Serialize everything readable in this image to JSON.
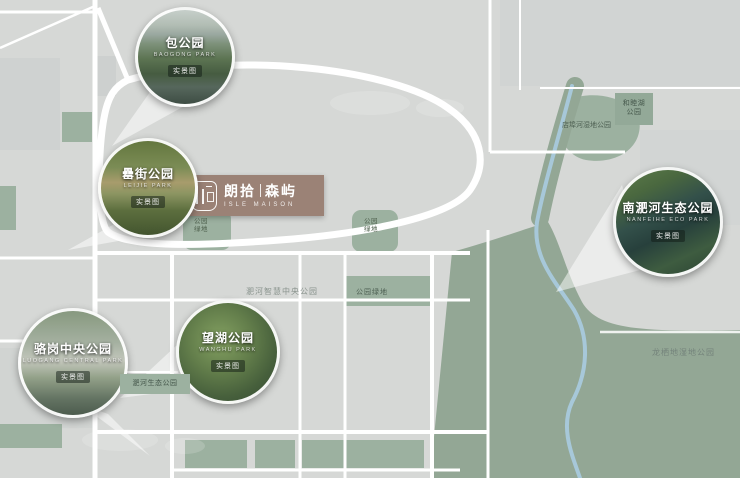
{
  "brand": {
    "cn_left": "朗拾",
    "divider": "|",
    "cn_right": "森屿",
    "english": "ISLE MAISON"
  },
  "circles": [
    {
      "label": "包公园",
      "subtitle": "BAOGONG PARK",
      "badge": "实景图"
    },
    {
      "label": "罍街公园",
      "subtitle": "LEIJIE PARK",
      "badge": "实景图"
    },
    {
      "label": "骆岗中央公园",
      "subtitle": "LUOGANG CENTRAL PARK",
      "badge": "实景图"
    },
    {
      "label": "望湖公园",
      "subtitle": "WANGHU PARK",
      "badge": "实景图"
    },
    {
      "label": "南淝河生态公园",
      "subtitle": "NANFEIHE ECO PARK",
      "badge": "实景图"
    }
  ],
  "map_labels": {
    "smart_central": "淝河智慧中央公园",
    "eco_park": "淝河生态公园",
    "longqidi": "龙栖地湿地公园",
    "dianbuhe": "店埠河湿地公园",
    "hemuhu": {
      "line1": "和睦湖",
      "line2": "公园"
    },
    "pocket_a": {
      "line1": "公园",
      "line2": "绿地"
    },
    "pocket_b": {
      "line1": "公园",
      "line2": "绿地"
    },
    "patch_note": "公园绿地"
  },
  "colors": {
    "map_background": "#d6d8d6",
    "road": "#ffffff",
    "park_green": "#9cb1a0",
    "river_blue": "#a8c9dc",
    "brand_plate": "#9b8276"
  }
}
